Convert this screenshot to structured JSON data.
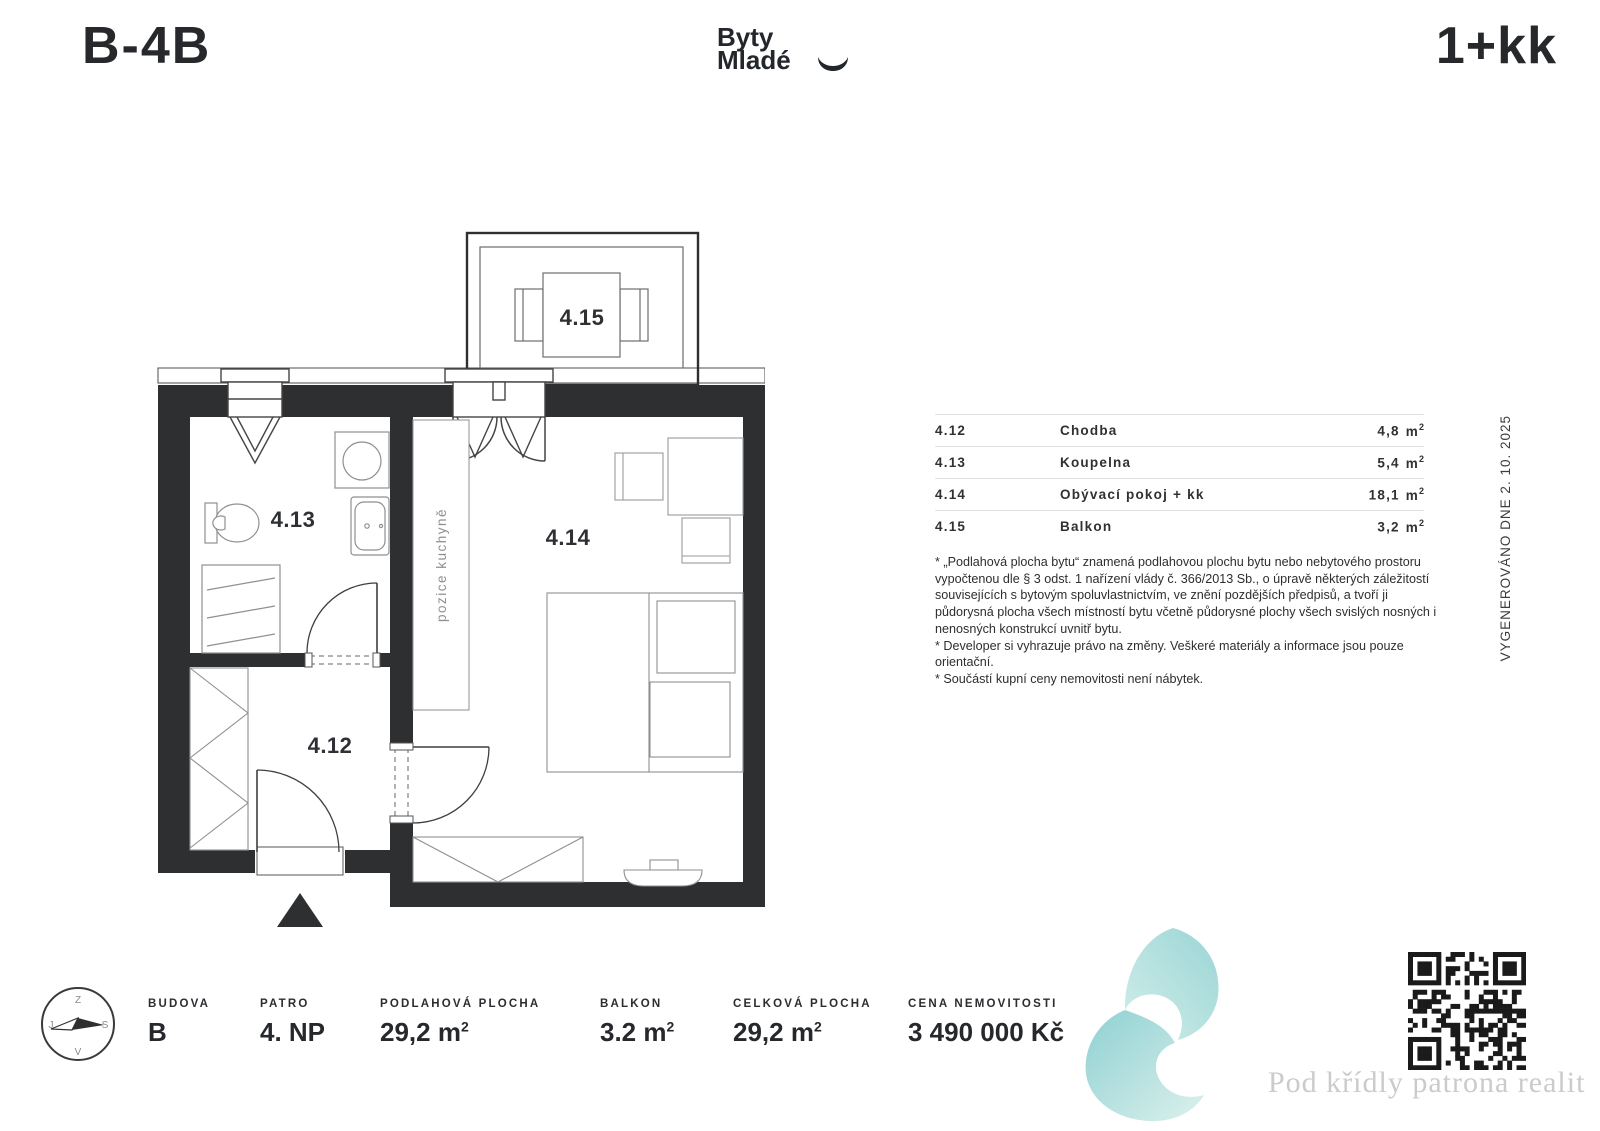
{
  "header": {
    "unit_code": "B-4B",
    "brand": {
      "line1": "Byty",
      "line2": "Mladé"
    },
    "layout_type": "1+kk"
  },
  "floorplan": {
    "labels": {
      "hallway": "4.12",
      "bathroom": "4.13",
      "living": "4.14",
      "balcony": "4.15"
    },
    "kitchen_note": "pozice kuchyně",
    "compass": {
      "top": "Z",
      "right": "S",
      "bottom": "V",
      "left": "J"
    }
  },
  "room_table": {
    "unit_base": "m",
    "unit_exp": "2",
    "rows": [
      {
        "code": "4.12",
        "name": "Chodba",
        "area": "4,8"
      },
      {
        "code": "4.13",
        "name": "Koupelna",
        "area": "5,4"
      },
      {
        "code": "4.14",
        "name": "Obývací pokoj + kk",
        "area": "18,1"
      },
      {
        "code": "4.15",
        "name": "Balkon",
        "area": "3,2"
      }
    ]
  },
  "disclaimer": {
    "note1": "* „Podlahová plocha bytu“ znamená podlahovou plochu bytu nebo nebytového prostoru vypočtenou dle § 3 odst. 1 nařízení vlády č. 366/2013 Sb., o úpravě některých záležitostí souvisejících s bytovým spoluvlastnictvím, ve znění pozdějších předpisů, a tvoří ji půdorysná plocha všech místností bytu včetně půdorysné plochy všech svislých nosných i nenosných konstrukcí uvnitř bytu.",
    "note2": "* Developer si vyhrazuje právo na změny. Veškeré materiály a informace jsou pouze orientační.",
    "note3": "* Součástí kupní ceny nemovitosti není nábytek."
  },
  "generated_note": "VYGENEROVÁNO DNE 2. 10. 2025",
  "stats": {
    "budova": {
      "label": "BUDOVA",
      "value": "B"
    },
    "patro": {
      "label": "PATRO",
      "value": "4. NP"
    },
    "podlahova_plocha": {
      "label": "PODLAHOVÁ PLOCHA",
      "value": "29,2 m",
      "sup": "2"
    },
    "balkon": {
      "label": "BALKON",
      "value": "3.2 m",
      "sup": "2"
    },
    "celkova_plocha": {
      "label": "CELKOVÁ PLOCHA",
      "value": "29,2 m",
      "sup": "2"
    },
    "cena": {
      "label": "CENA NEMOVITOSTI",
      "value": "3 490 000 Kč"
    }
  },
  "footer": {
    "watermark": "Pod křídly patrona realit"
  },
  "colors": {
    "wall": "#2e2f31",
    "brand_teal_dark": "#8fd0d2",
    "brand_teal_light": "#dcf1ed",
    "watermark_gray": "#cbcbcb"
  }
}
